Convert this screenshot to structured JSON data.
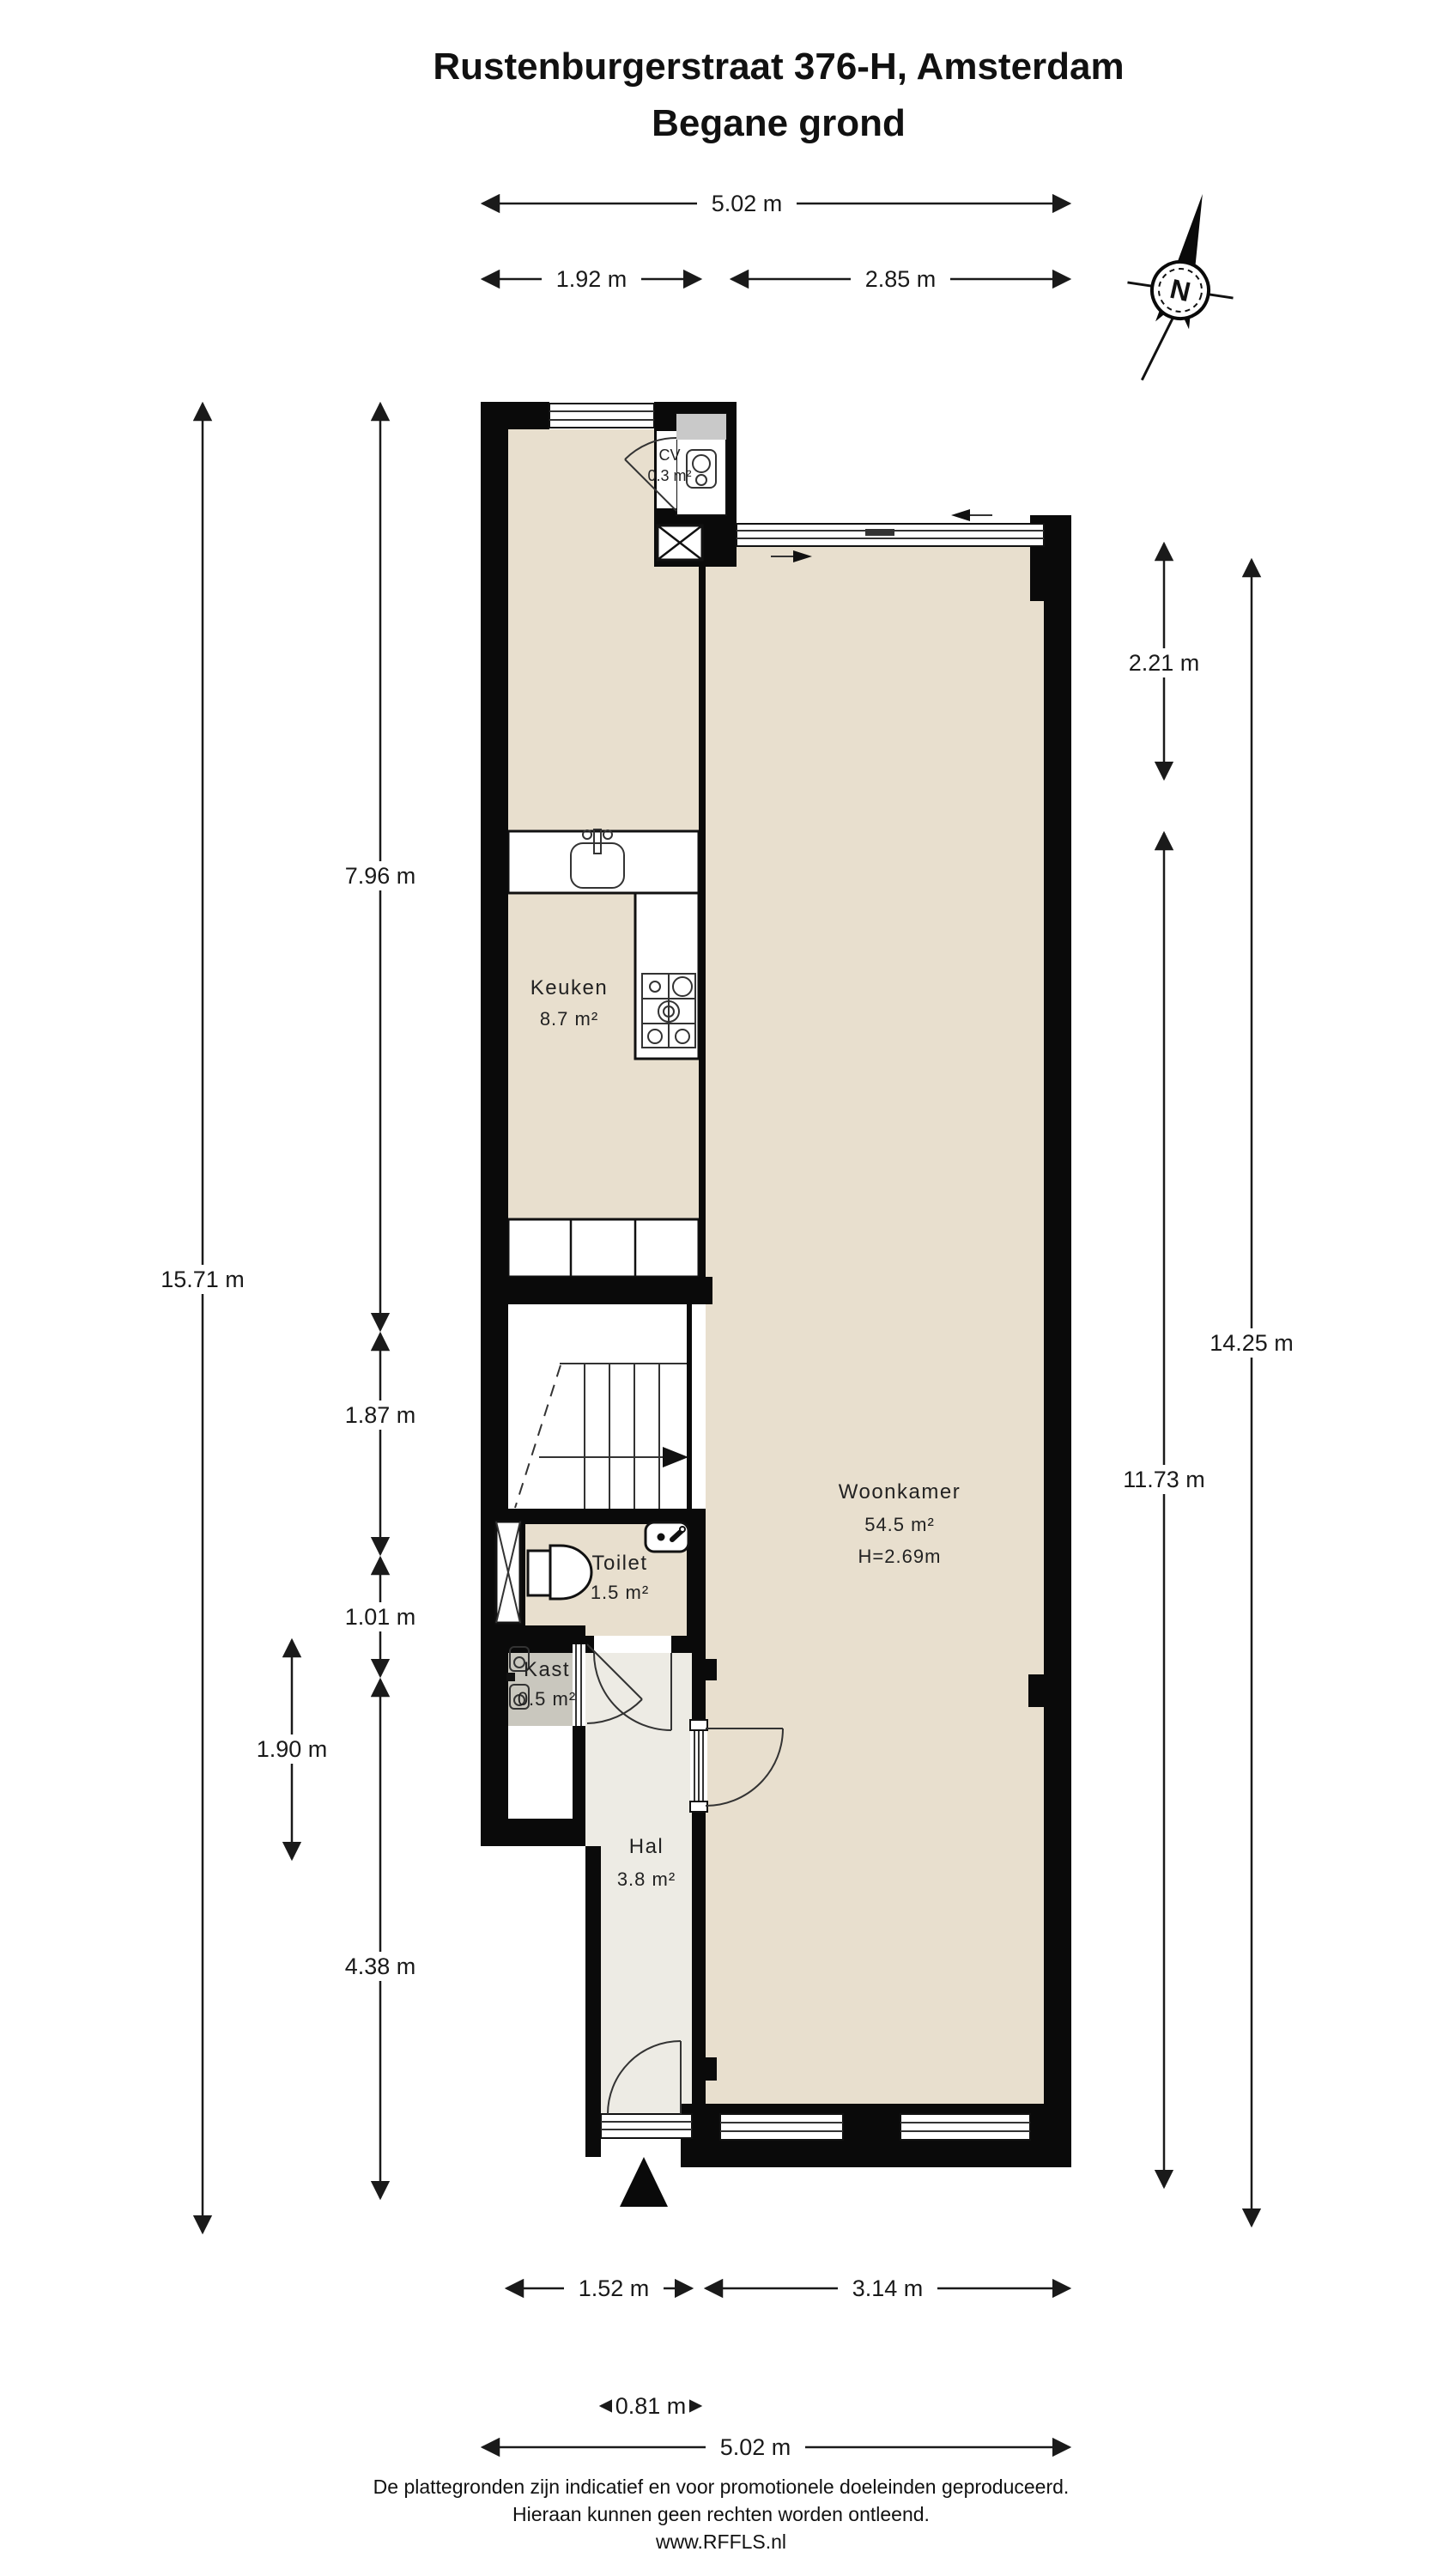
{
  "title": {
    "line1": "Rustenburgerstraat 376-H, Amsterdam",
    "line2": "Begane grond"
  },
  "compass": {
    "north_label": "N"
  },
  "rooms": {
    "cv": {
      "name": "CV",
      "area": "0.3 m²"
    },
    "keuken": {
      "name": "Keuken",
      "area": "8.7 m²"
    },
    "woonkamer": {
      "name": "Woonkamer",
      "area": "54.5 m²",
      "ceiling_height": "H=2.69m"
    },
    "toilet": {
      "name": "Toilet",
      "area": "1.5 m²"
    },
    "kast": {
      "name": "Kast",
      "area": "0.5 m²"
    },
    "hal": {
      "name": "Hal",
      "area": "3.8 m²"
    }
  },
  "dimensions": {
    "top_total": "5.02 m",
    "top_left_section": "1.92 m",
    "top_right_section": "2.85 m",
    "left_total": "15.71 m",
    "left_kitchen_section": "7.96 m",
    "left_stair_section": "1.87 m",
    "left_toilet_section": "1.01 m",
    "left_kast_section": "1.90 m",
    "left_hal_section": "4.38 m",
    "right_upper_section": "2.21 m",
    "right_living_section": "11.73 m",
    "right_total": "14.25 m",
    "bottom_hal_section": "1.52 m",
    "bottom_living_section": "3.14 m",
    "bottom_door_width": "0.81 m",
    "bottom_total": "5.02 m"
  },
  "footer": {
    "line1": "De plattegronden zijn indicatief en voor promotionele doeleinden geproduceerd.",
    "line2": "Hieraan kunnen geen rechten worden ontleend.",
    "line3": "www.RFFLS.nl"
  },
  "colors": {
    "wall": "#0a0a0a",
    "floor_main": "#e8dfce",
    "floor_hal": "#edebe4",
    "floor_kast": "#c9c7be",
    "dimension_line": "#1a1a1a"
  }
}
